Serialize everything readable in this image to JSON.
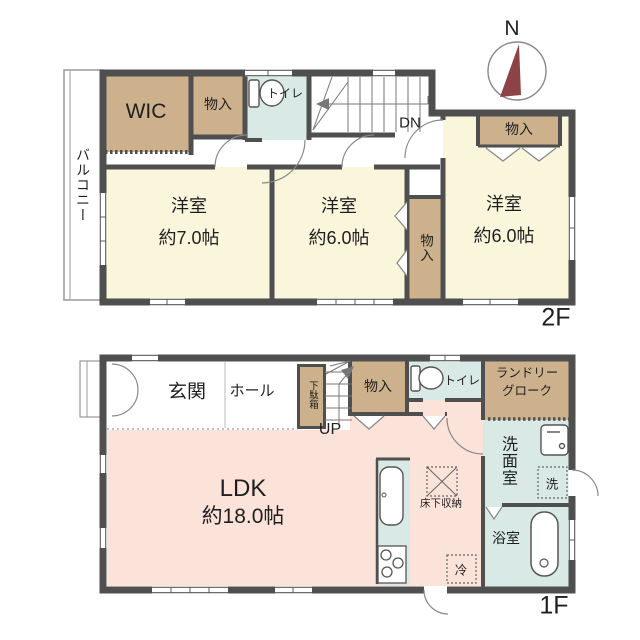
{
  "compass": {
    "north_label": "N"
  },
  "colors": {
    "wall": "#4F4F4F",
    "room_cream": "#FAF6DC",
    "closet_tan": "#CDB18D",
    "water_cyan": "#D9EAE6",
    "ldk_pink": "#FBE3D9",
    "compass_needle": "#8C4347"
  },
  "floor2": {
    "floor_label": "2F",
    "balcony": "バルコニー",
    "wic": "WIC",
    "closet_top": "物入",
    "toilet": "トイレ",
    "stairs_down": "DN",
    "room_west": {
      "name": "洋室",
      "size": "約7.0帖"
    },
    "room_mid": {
      "name": "洋室",
      "size": "約6.0帖"
    },
    "closet_mid": "物入",
    "room_east": {
      "name": "洋室",
      "size": "約6.0帖"
    },
    "closet_east": "物入"
  },
  "floor1": {
    "floor_label": "1F",
    "entrance": "玄関",
    "hall": "ホール",
    "shoe_cabinet": "下駄箱",
    "stairs_up": "UP",
    "closet": "物入",
    "toilet": "トイレ",
    "laundry_line1": "ランドリー",
    "laundry_line2": "グローク",
    "washroom": "洗面室",
    "washer": "洗",
    "bathroom": "浴室",
    "ldk": {
      "name": "LDK",
      "size": "約18.0帖"
    },
    "underfloor_storage": "床下収納",
    "fridge": "冷"
  }
}
